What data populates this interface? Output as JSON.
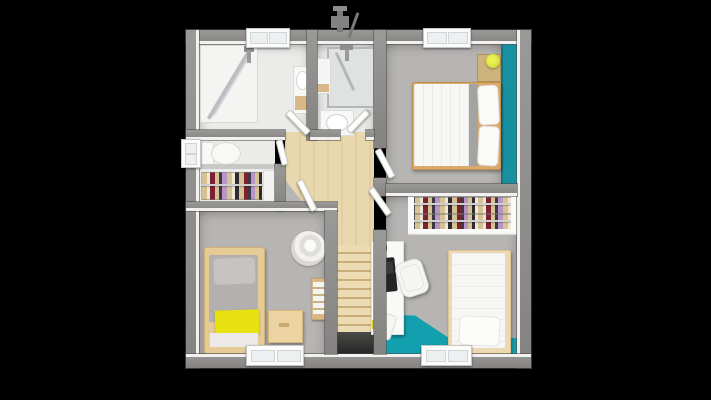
{
  "scene": {
    "type": "3d-floor-plan-render",
    "view": "top-down",
    "floor": "upper storey with central staircase",
    "background": "#000000"
  },
  "colors": {
    "background": "#000000",
    "wall": "#8c8c8a",
    "wall_dark": "#5e5e5c",
    "wall_face": "#f2f1ef",
    "floor_bath": "#ebebe9",
    "floor_bedroom": "#b7b5b3",
    "floor_wood": "#e9d8ae",
    "stair_tread": "#eddcb3",
    "stair_shadow": "#c9ae7c",
    "stair_void": "#3c3c3a",
    "accent_teal_wall": "#1791a1",
    "accent_teal_floor": "#13a0ae",
    "bed_wood": "#d9aa6b",
    "bed_wood_light": "#e6cb96",
    "bed_frame_cream": "#ecd9b4",
    "bedding_white": "#f6f6f4",
    "bedding_gray": "#b3b1af",
    "blanket_yellow": "#e8e111",
    "lamp_yellow": "#d8e23c",
    "laptop_black": "#242426",
    "desk_white": "#f9f9f8",
    "clothes": [
      "#d6c394",
      "#efe8d9",
      "#7c2230",
      "#3e3844",
      "#b795c6",
      "#2f2b30"
    ]
  },
  "rooms": [
    {
      "id": "bathroom-main",
      "features": [
        "walk-in-shower",
        "glass-screen",
        "vanity-sink",
        "window"
      ]
    },
    {
      "id": "shower-room",
      "features": [
        "shower-cabin",
        "shower-column",
        "washbasin",
        "wall-cabinet"
      ]
    },
    {
      "id": "bedroom-master",
      "features": [
        "double-bed",
        "two-pillows",
        "nightstand",
        "yellow-lamp",
        "teal-accent-wall",
        "double-window"
      ]
    },
    {
      "id": "wc",
      "features": [
        "toilet",
        "small-window"
      ]
    },
    {
      "id": "dressing-left",
      "features": [
        "clothes-rail",
        "cabinet"
      ]
    },
    {
      "id": "hallway",
      "features": [
        "wood-floor",
        "staircase-down",
        "five-doors"
      ]
    },
    {
      "id": "bedroom-left",
      "features": [
        "single-bed",
        "gray-duvet",
        "yellow-blanket",
        "round-rug",
        "nightstand",
        "drawer-unit",
        "window"
      ]
    },
    {
      "id": "bedroom-right",
      "features": [
        "single-bed",
        "white-duvet",
        "desk",
        "laptop",
        "desk-chair",
        "double-clothes-rail",
        "teal-floor",
        "window"
      ]
    }
  ]
}
